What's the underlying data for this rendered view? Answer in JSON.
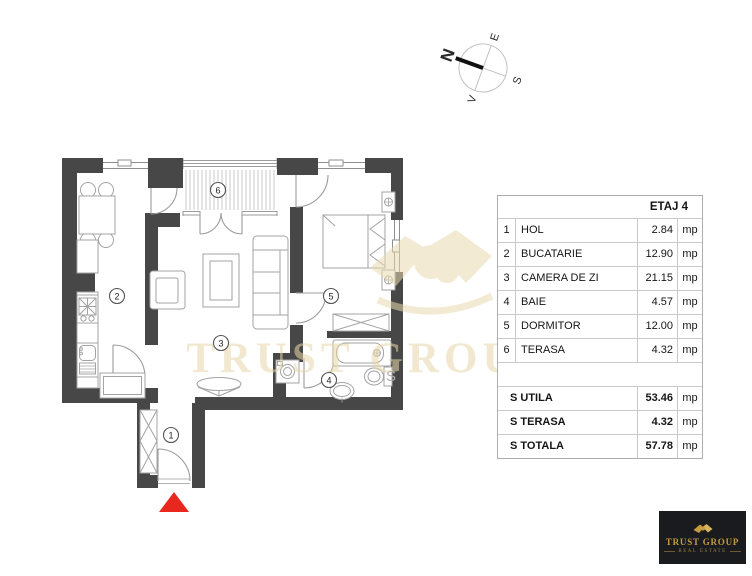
{
  "compass": {
    "n": "N",
    "e": "E",
    "s": "S",
    "v": "V"
  },
  "floorplan": {
    "labels": [
      "1",
      "2",
      "3",
      "4",
      "5",
      "6"
    ]
  },
  "watermark": {
    "brand": "TRUST GROUP",
    "mark": "S"
  },
  "area_table": {
    "header": "ETAJ 4",
    "rows": [
      {
        "num": "1",
        "name": "HOL",
        "value": "2.84",
        "unit": "mp"
      },
      {
        "num": "2",
        "name": "BUCATARIE",
        "value": "12.90",
        "unit": "mp"
      },
      {
        "num": "3",
        "name": "CAMERA DE ZI",
        "value": "21.15",
        "unit": "mp"
      },
      {
        "num": "4",
        "name": "BAIE",
        "value": "4.57",
        "unit": "mp"
      },
      {
        "num": "5",
        "name": "DORMITOR",
        "value": "12.00",
        "unit": "mp"
      },
      {
        "num": "6",
        "name": "TERASA",
        "value": "4.32",
        "unit": "mp"
      }
    ],
    "totals": [
      {
        "name": "S UTILA",
        "value": "53.46",
        "unit": "mp"
      },
      {
        "name": "S TERASA",
        "value": "4.32",
        "unit": "mp"
      },
      {
        "name": "S TOTALA",
        "value": "57.78",
        "unit": "mp"
      }
    ]
  },
  "logo": {
    "brand": "TRUST GROUP",
    "tagline": "REAL ESTATE"
  },
  "colors": {
    "wall": "#474747",
    "furniture_line": "#a3a3a3",
    "entrance_red": "#e8281e",
    "watermark": "#e8d9ae",
    "logo_bg": "#1a1b1e",
    "logo_gold": "#c49b40"
  }
}
